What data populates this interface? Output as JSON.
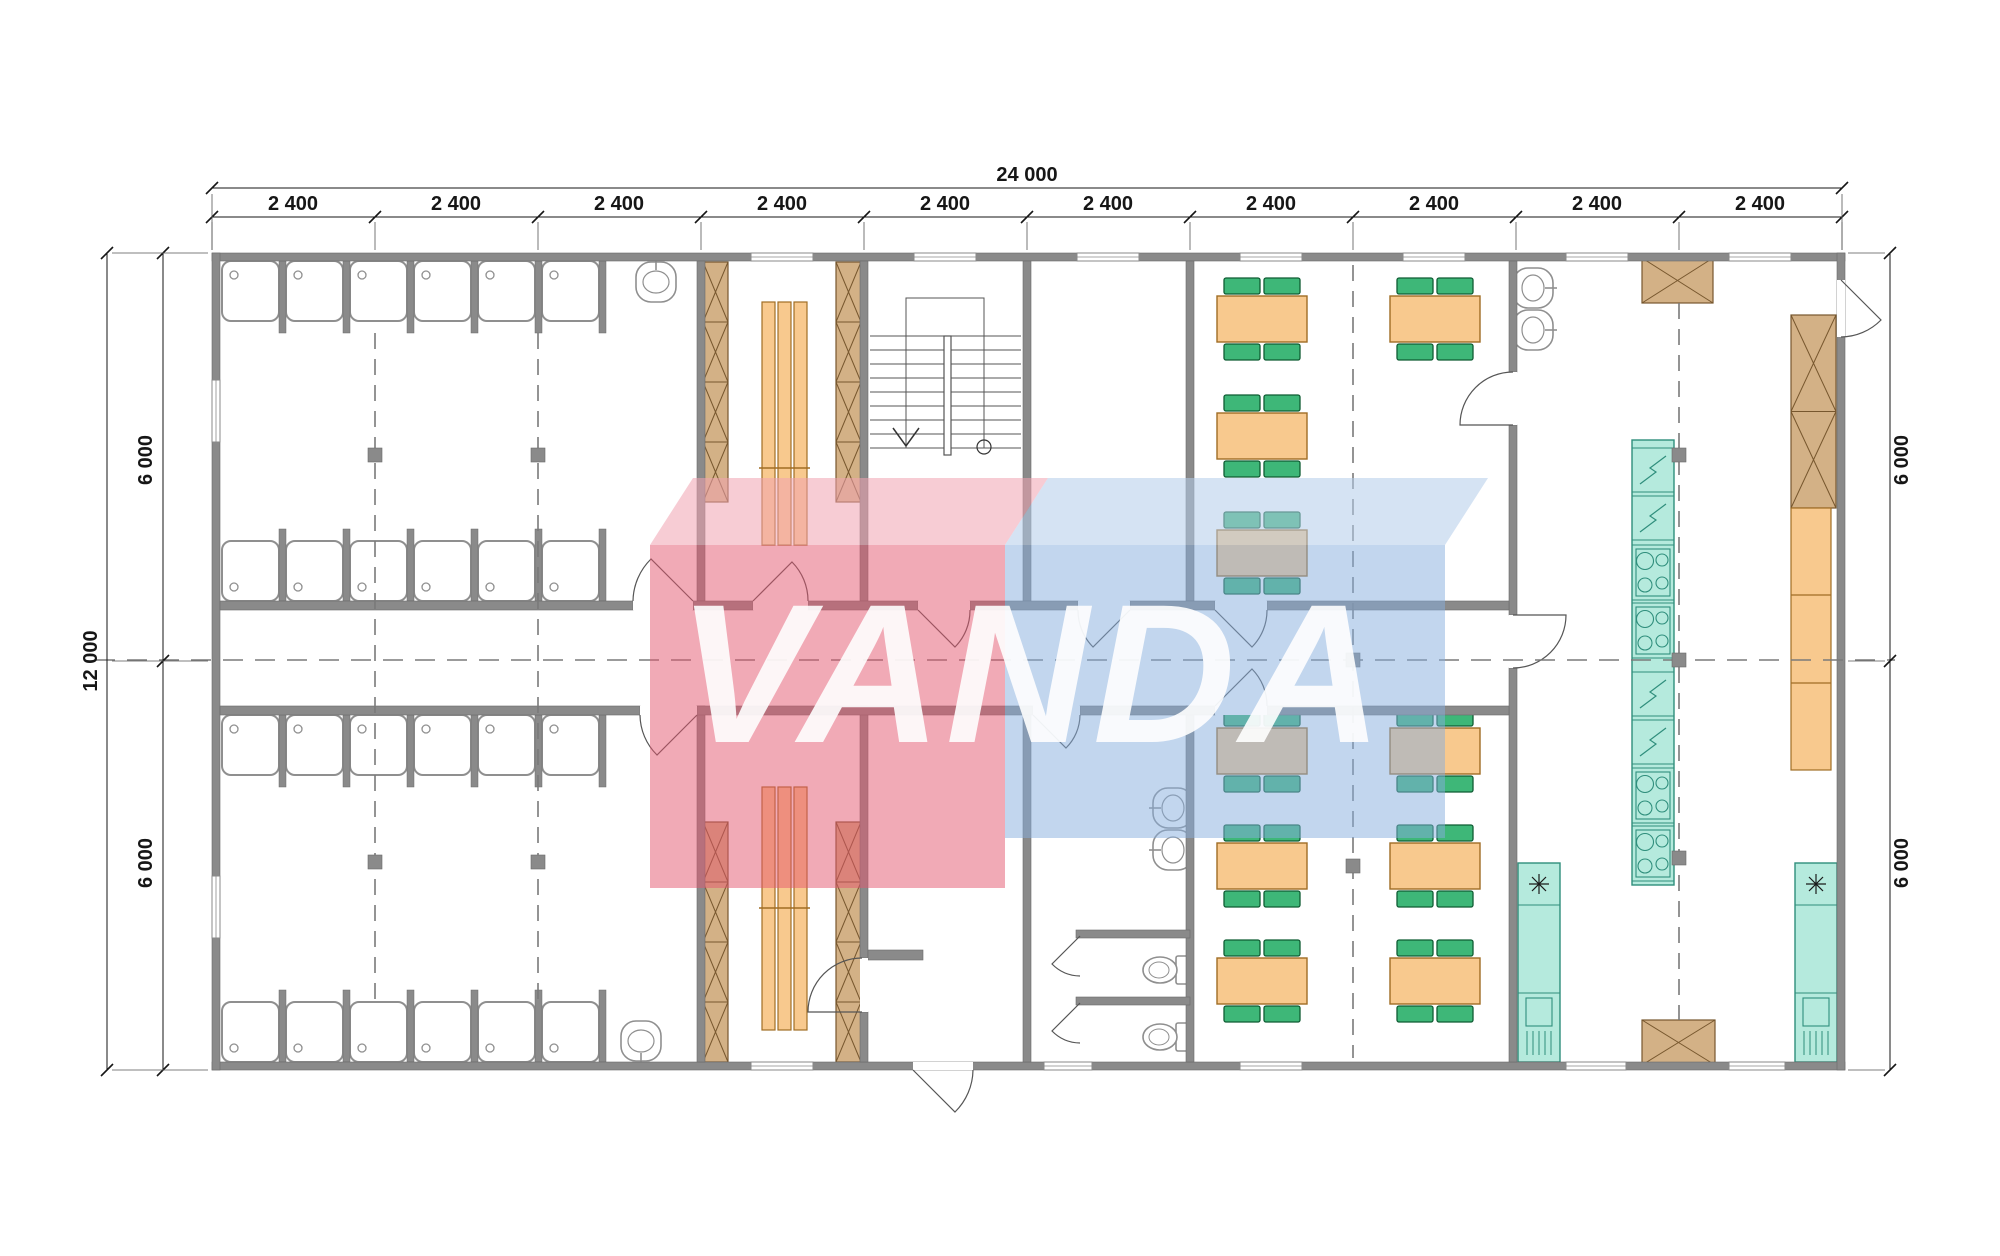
{
  "watermark": {
    "text": "VANDA",
    "red_color": "#e4556e",
    "red_top_color": "#f0a2b1",
    "blue_color": "#86aedd",
    "blue_top_color": "#b3cce9"
  },
  "dimensions": {
    "total_width": "24 000",
    "total_height": "12 000",
    "bays": [
      "2 400",
      "2 400",
      "2 400",
      "2 400",
      "2 400",
      "2 400",
      "2 400",
      "2 400",
      "2 400",
      "2 400"
    ],
    "left": [
      "6 000",
      "6 000"
    ],
    "right": [
      "6 000",
      "6 000"
    ]
  },
  "plan": {
    "colors": {
      "wall": "#8a8a8a",
      "wallStroke": "#6b6b6b",
      "tan": "#d3b186",
      "tanStroke": "#77572e",
      "orange": "#f8c98e",
      "orangeStroke": "#a06d24",
      "green": "#3eb778",
      "greenStroke": "#0f5c33",
      "teal": "#b5eadd",
      "tealStroke": "#2f8e7c",
      "line": "#444444",
      "dash": "#7a7a7a",
      "fix": "#8f8f8f"
    },
    "grid_x": [
      212,
      375,
      538,
      701,
      864,
      1027,
      1190,
      1353,
      1516,
      1679,
      1842
    ],
    "bay_centers": [
      293,
      456,
      619,
      782,
      945,
      1108,
      1271,
      1434,
      1597,
      1760
    ],
    "walls": [
      [
        212,
        253,
        1633,
        8
      ],
      [
        212,
        1062,
        1633,
        8
      ],
      [
        212,
        253,
        8,
        817
      ],
      [
        1837,
        253,
        8,
        817
      ],
      [
        697,
        261,
        8,
        340
      ],
      [
        697,
        706,
        8,
        356
      ],
      [
        860,
        261,
        8,
        340
      ],
      [
        860,
        706,
        8,
        252
      ],
      [
        860,
        1012,
        8,
        50
      ],
      [
        1023,
        261,
        8,
        340
      ],
      [
        1023,
        706,
        8,
        356
      ],
      [
        1186,
        261,
        8,
        340
      ],
      [
        1186,
        706,
        8,
        356
      ],
      [
        1509,
        261,
        8,
        111
      ],
      [
        1509,
        425,
        8,
        190
      ],
      [
        1509,
        668,
        8,
        394
      ],
      [
        220,
        601,
        413,
        9
      ],
      [
        693,
        601,
        60,
        9
      ],
      [
        808,
        601,
        110,
        9
      ],
      [
        970,
        601,
        108,
        9
      ],
      [
        1130,
        601,
        85,
        9
      ],
      [
        1267,
        601,
        242,
        9
      ],
      [
        220,
        706,
        420,
        9
      ],
      [
        697,
        706,
        336,
        9
      ],
      [
        1080,
        706,
        135,
        9
      ],
      [
        1267,
        706,
        242,
        9
      ],
      [
        1076,
        930,
        114,
        8
      ],
      [
        1076,
        997,
        114,
        8
      ],
      [
        868,
        950,
        55,
        10
      ]
    ],
    "windows_h": [
      [
        751,
        253,
        62
      ],
      [
        914,
        253,
        62
      ],
      [
        1077,
        253,
        62
      ],
      [
        1240,
        253,
        62
      ],
      [
        1403,
        253,
        62
      ],
      [
        1566,
        253,
        62
      ],
      [
        1729,
        253,
        62
      ],
      [
        751,
        1062,
        62
      ],
      [
        1044,
        1062,
        48
      ],
      [
        1240,
        1062,
        62
      ],
      [
        1566,
        1062,
        60
      ],
      [
        1729,
        1062,
        56
      ]
    ],
    "windows_v": [
      [
        212,
        380,
        62
      ],
      [
        212,
        876,
        62
      ]
    ],
    "door_gaps": [
      [
        633,
        601,
        60,
        9
      ],
      [
        753,
        601,
        55,
        9
      ],
      [
        918,
        601,
        52,
        9
      ],
      [
        1078,
        601,
        52,
        9
      ],
      [
        1215,
        601,
        52,
        9
      ],
      [
        640,
        706,
        57,
        9
      ],
      [
        1033,
        706,
        47,
        9
      ],
      [
        1215,
        706,
        52,
        9
      ],
      [
        913,
        1062,
        60,
        8
      ],
      [
        1837,
        280,
        8,
        57
      ],
      [
        1509,
        372,
        8,
        53
      ],
      [
        1509,
        615,
        8,
        53
      ],
      [
        860,
        958,
        8,
        54
      ]
    ],
    "doors": [
      {
        "hinge": [
          693,
          601
        ],
        "tip": [
          651,
          559
        ],
        "jamb": [
          633,
          601
        ],
        "sweep": 0
      },
      {
        "hinge": [
          753,
          601
        ],
        "tip": [
          792,
          562
        ],
        "jamb": [
          808,
          601
        ],
        "sweep": 1
      },
      {
        "hinge": [
          918,
          610
        ],
        "tip": [
          955,
          647
        ],
        "jamb": [
          970,
          610
        ],
        "sweep": 0
      },
      {
        "hinge": [
          1130,
          610
        ],
        "tip": [
          1093,
          647
        ],
        "jamb": [
          1078,
          610
        ],
        "sweep": 1
      },
      {
        "hinge": [
          1215,
          610
        ],
        "tip": [
          1252,
          647
        ],
        "jamb": [
          1267,
          610
        ],
        "sweep": 0
      },
      {
        "hinge": [
          697,
          715
        ],
        "tip": [
          657,
          755
        ],
        "jamb": [
          640,
          715
        ],
        "sweep": 1
      },
      {
        "hinge": [
          1033,
          715
        ],
        "tip": [
          1066,
          748
        ],
        "jamb": [
          1080,
          715
        ],
        "sweep": 0
      },
      {
        "hinge": [
          1215,
          706
        ],
        "tip": [
          1252,
          669
        ],
        "jamb": [
          1267,
          706
        ],
        "sweep": 1
      },
      {
        "hinge": [
          913,
          1070
        ],
        "tip": [
          955,
          1112
        ],
        "jamb": [
          973,
          1070
        ],
        "sweep": 0
      },
      {
        "hinge": [
          1841,
          280
        ],
        "tip": [
          1881,
          320
        ],
        "jamb": [
          1841,
          337
        ],
        "sweep": 1
      },
      {
        "hinge": [
          1513,
          425
        ],
        "tip": [
          1460,
          425
        ],
        "jamb": [
          1513,
          372
        ],
        "sweep": 1
      },
      {
        "hinge": [
          1513,
          615
        ],
        "tip": [
          1566,
          615
        ],
        "jamb": [
          1513,
          668
        ],
        "sweep": 1
      },
      {
        "hinge": [
          862,
          1012
        ],
        "tip": [
          808,
          1012
        ],
        "jamb": [
          862,
          958
        ],
        "sweep": 1
      },
      {
        "hinge": [
          1080,
          936
        ],
        "tip": [
          1052,
          964
        ],
        "jamb": [
          1080,
          976
        ],
        "sweep": 0
      },
      {
        "hinge": [
          1080,
          1003
        ],
        "tip": [
          1052,
          1031
        ],
        "jamb": [
          1080,
          1043
        ],
        "sweep": 0
      }
    ],
    "stall_xs": [
      222,
      286,
      350,
      414,
      478,
      542
    ],
    "stall_w": 57,
    "stall_h": 60,
    "stall_rows": [
      {
        "y": 261,
        "drain": "top"
      },
      {
        "y": 541,
        "drain": "bottom"
      },
      {
        "y": 715,
        "drain": "top"
      },
      {
        "y": 1002,
        "drain": "bottom"
      }
    ],
    "partition_rows": [
      {
        "y": 261,
        "h": 72
      },
      {
        "y": 529,
        "h": 72
      },
      {
        "y": 715,
        "h": 72
      },
      {
        "y": 990,
        "h": 72
      }
    ],
    "partition_xs": [
      279,
      343,
      407,
      471,
      535,
      599
    ],
    "basins": [
      {
        "cx": 656,
        "cy": 284,
        "rot": 0
      },
      {
        "cx": 641,
        "cy": 1039,
        "rot": 180
      },
      {
        "cx": 1531,
        "cy": 288,
        "rot": 90
      },
      {
        "cx": 1531,
        "cy": 330,
        "rot": 90
      },
      {
        "cx": 1175,
        "cy": 808,
        "rot": -90
      },
      {
        "cx": 1175,
        "cy": 850,
        "rot": -90
      }
    ],
    "toilets": [
      {
        "cx": 1160,
        "cy": 970
      },
      {
        "cx": 1160,
        "cy": 1037
      }
    ],
    "lockers": [
      {
        "x": 703,
        "y": 262,
        "w": 25,
        "h": 240,
        "n": 4
      },
      {
        "x": 836,
        "y": 262,
        "w": 25,
        "h": 240,
        "n": 4
      },
      {
        "x": 703,
        "y": 822,
        "w": 25,
        "h": 240,
        "n": 4
      },
      {
        "x": 836,
        "y": 822,
        "w": 25,
        "h": 240,
        "n": 4
      },
      {
        "x": 1791,
        "y": 315,
        "w": 45,
        "h": 193,
        "n": 2
      },
      {
        "x": 1642,
        "y": 258,
        "w": 71,
        "h": 45,
        "n": 1
      },
      {
        "x": 1642,
        "y": 1020,
        "w": 73,
        "h": 45,
        "n": 1
      }
    ],
    "benches": [
      {
        "x": 762,
        "y": 302,
        "w": 45,
        "h": 243,
        "div": 468
      },
      {
        "x": 762,
        "y": 787,
        "w": 45,
        "h": 243,
        "div": 908
      }
    ],
    "counter": {
      "x": 1791,
      "y": 508,
      "w": 40,
      "h": 262,
      "divs": [
        595,
        683
      ]
    },
    "island": {
      "x": 1632,
      "y": 440,
      "w": 42,
      "h": 445,
      "sections": [
        {
          "t": "fridge",
          "y": 448,
          "h": 44
        },
        {
          "t": "fridge",
          "y": 496,
          "h": 44
        },
        {
          "t": "cook",
          "y": 545,
          "h": 55
        },
        {
          "t": "cook",
          "y": 603,
          "h": 55
        },
        {
          "t": "fridge",
          "y": 672,
          "h": 44
        },
        {
          "t": "fridge",
          "y": 720,
          "h": 44
        },
        {
          "t": "cook",
          "y": 768,
          "h": 55
        },
        {
          "t": "cook",
          "y": 826,
          "h": 55
        }
      ]
    },
    "sink_units": [
      {
        "x": 1518,
        "y": 863,
        "w": 42,
        "h": 199
      },
      {
        "x": 1795,
        "y": 863,
        "w": 42,
        "h": 199
      }
    ],
    "tables": [
      [
        1217,
        296
      ],
      [
        1217,
        413
      ],
      [
        1217,
        530
      ],
      [
        1390,
        296
      ],
      [
        1217,
        728
      ],
      [
        1390,
        728
      ],
      [
        1217,
        843
      ],
      [
        1390,
        843
      ],
      [
        1217,
        958
      ],
      [
        1390,
        958
      ]
    ],
    "table_w": 90,
    "table_h": 46,
    "stairs": {
      "outline": [
        906,
        298,
        78,
        150
      ],
      "tread_x": [
        870,
        1021
      ],
      "tread_ys": [
        336,
        350,
        364,
        378,
        392,
        406,
        420,
        434,
        448
      ],
      "rail": [
        944,
        336,
        7,
        119
      ],
      "arrow": [
        [
          893,
          428
        ],
        [
          906,
          446
        ],
        [
          919,
          428
        ]
      ],
      "circle": [
        984,
        447,
        7
      ]
    },
    "markers": [
      [
        368,
        448
      ],
      [
        531,
        448
      ],
      [
        368,
        855
      ],
      [
        531,
        855
      ],
      [
        1346,
        653
      ],
      [
        1346,
        859
      ],
      [
        1672,
        448
      ],
      [
        1672,
        653
      ],
      [
        1672,
        851
      ]
    ],
    "dash_v": [
      {
        "x": 375,
        "y1": 333,
        "y2": 1000
      },
      {
        "x": 538,
        "y1": 333,
        "y2": 1000
      },
      {
        "x": 1353,
        "y1": 265,
        "y2": 1058
      },
      {
        "x": 1679,
        "y1": 303,
        "y2": 1020
      }
    ],
    "dash_h": {
      "y": 660,
      "x1": 95,
      "x2": 1895
    },
    "dims": {
      "top_total_y": 188,
      "top_bay_y": 217,
      "left_outer_x": 107,
      "left_inner_x": 163,
      "right_x": 1890,
      "v_ticks_y": [
        253,
        661,
        1070
      ],
      "top_span": [
        212,
        1842
      ],
      "side_span": [
        253,
        1070
      ]
    }
  }
}
